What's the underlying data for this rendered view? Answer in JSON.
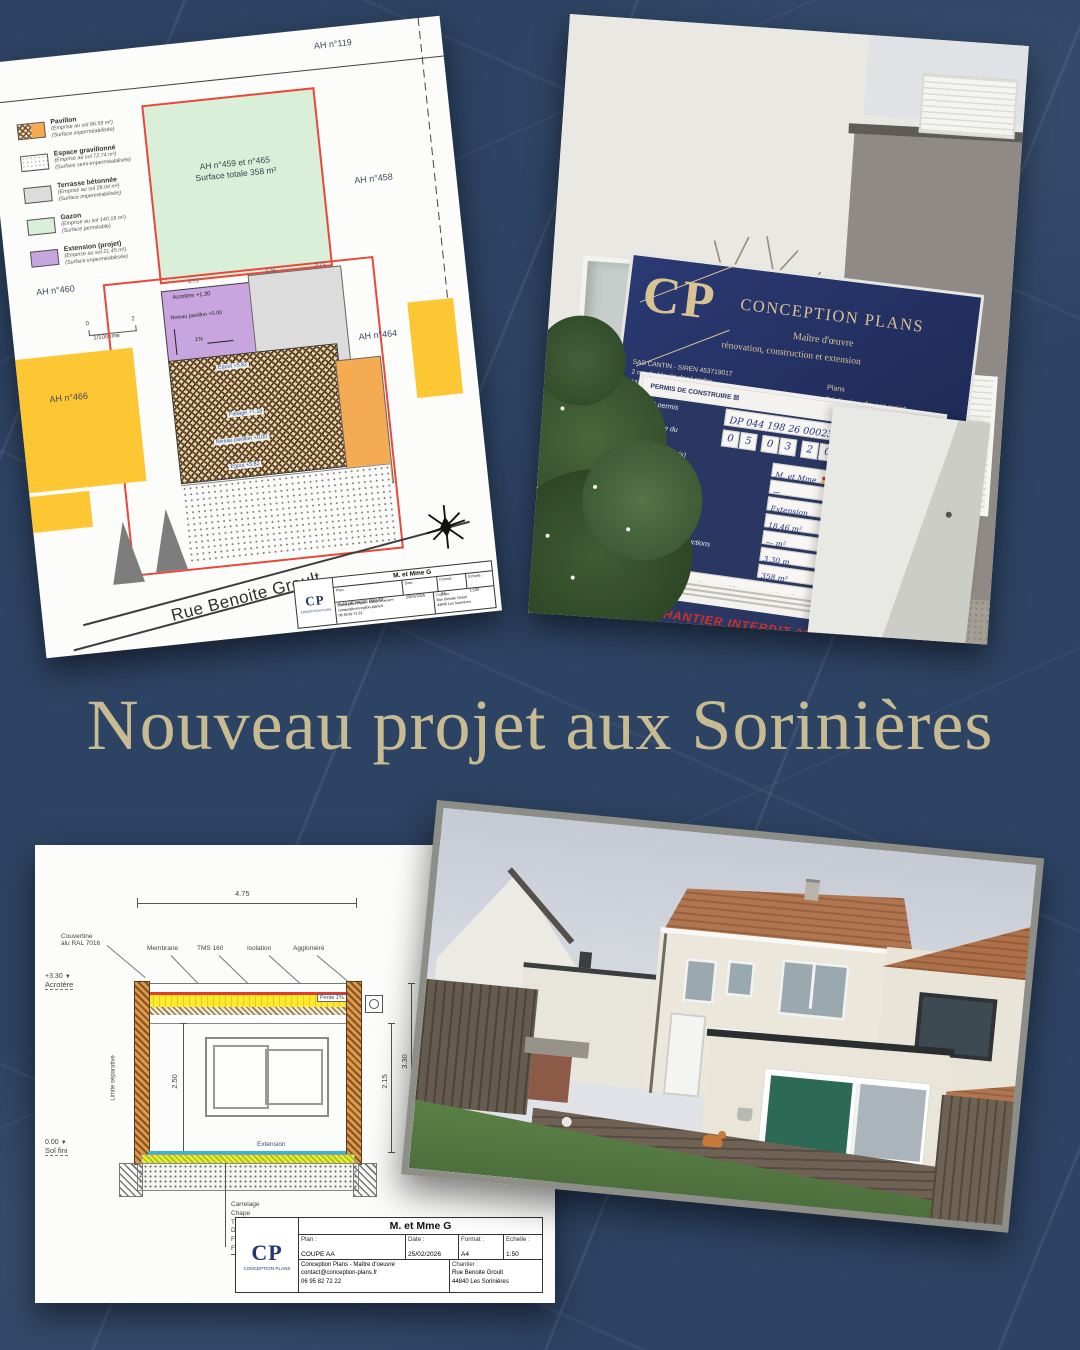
{
  "headline": "Nouveau projet aux Sorinières",
  "site_plan": {
    "parcel_ah119": "AH n°119",
    "parcel_ah458": "AH n°458",
    "parcel_ah460": "AH n°460",
    "parcel_ah464": "AH n°464",
    "parcel_ah466": "AH n°466",
    "green_line1": "AH n°459 et n°465",
    "green_line2": "Surface totale 358 m²",
    "legend": [
      {
        "name": "Pavillon",
        "emprise": "(Emprise au sol 86.59 m²)",
        "surface": "(Surface imperméabilisée)"
      },
      {
        "name": "Espace gravillonné",
        "emprise": "(Emprise au sol 72.74 m²)",
        "surface": "(Surface semi-imperméabilisée)"
      },
      {
        "name": "Terrasse bétonnée",
        "emprise": "(Emprise au sol 28.04 m²)",
        "surface": "(Surface imperméabilisée)"
      },
      {
        "name": "Gazon",
        "emprise": "(Emprise au sol 140.18 m²)",
        "surface": "(Surface perméable)"
      },
      {
        "name": "Extension (projet)",
        "emprise": "(Emprise au sol 21.45 m²)",
        "surface": "(Surface imperméabilisée)"
      }
    ],
    "scale": {
      "left": "0",
      "right": "2",
      "label": "1/100ème"
    },
    "dims": {
      "d1": "4.75",
      "d2": "3.26",
      "d3": "3.71"
    },
    "ann_acrotere130": "Acrotère +1.30",
    "ann_niveau": "Niveau pavillon +0.00",
    "ann_pente1": "1%",
    "ann_egout_top": "Egout +5.82",
    "ann_faitage": "Faîtage +7.18",
    "ann_niveau2": "Niveau pavillon +0.00",
    "ann_egout_bottom": "Egout +5.82",
    "ann_acrotere330": "Acrotère +3.30",
    "street": "Rue Benoite Groult",
    "titleblock": {
      "logo_text": "CP",
      "logo_caption": "CONCEPTION PLANS",
      "client": "M. et Mme G",
      "plan_label": "Plan :",
      "plan_value": "PLAN DE MASSE PROJET",
      "date_label": "Date :",
      "date_value": "25/02/2026",
      "format_label": "Format :",
      "format_value": "A3",
      "echelle_label": "Echelle :",
      "echelle_value": "1:100",
      "company": "Conception Plans - Maître d'oeuvre",
      "email": "contact@conception-plans.fr",
      "phone": "06 95 82 72 22",
      "chantier_label": "Chantier :",
      "chantier1": "Rue Benoite Groult",
      "chantier2": "44840 Les Sorinières"
    }
  },
  "photo_top": {
    "sign": {
      "logo_text": "CP",
      "brand": "CONCEPTION PLANS",
      "tagline1": "Maître d'œuvre",
      "tagline2": "rénovation, construction et extension",
      "info": [
        "SAS CANTIN - SIREN 453719017",
        "2 rue du Moulin des Landes",
        "44840 LES SORINIÈRES",
        "06 95 82 72 22",
        "contact@conception-plans.fr",
        "www.conception-plans.fr"
      ],
      "services": [
        "Plans",
        "Réalisation d'avant-projet",
        "Permis de construire",
        "Suivi de chantier",
        "Accompagnement personnalisé"
      ]
    },
    "permit": {
      "title_left": "PERMIS DE CONSTRUIRE",
      "check_left": "☒",
      "title_right": "PERMIS DE DÉMOLIR",
      "check_right": "☐",
      "num_label": "N° permis",
      "num_value": "DP 044 198 26 00023",
      "date_label": "en date du",
      "date_digits": [
        "0",
        "5",
        "0",
        "3",
        "2",
        "0",
        "2",
        "6"
      ],
      "rows": [
        {
          "label": "Bénéficiaire(s)",
          "value": "M. et Mme"
        },
        {
          "label": "Architecte",
          "value": "—"
        },
        {
          "label": "Nature des travaux",
          "value": "Extension"
        },
        {
          "label": "Surface plancher",
          "value": "18,46 m²"
        },
        {
          "label": "Surface existante",
          "value": "—  m²"
        },
        {
          "label": "Hauteur des constructions",
          "value": "3,30 m"
        },
        {
          "label": "Superficie du terrain",
          "value": "358 m²"
        },
        {
          "label": "Mairie",
          "value": "Rue Georges Clemenceau, Les Sorinières (44840)"
        }
      ],
      "warning": "CHANTIER INTERDIT AU PUBLIC"
    }
  },
  "coupe": {
    "dim_top": "4.75",
    "lbl_couvertine": "Couvertine",
    "lbl_couvertine2": "alu RAL 7016",
    "lbl_membrane": "Membrane",
    "lbl_tms": "TMS 160",
    "lbl_isolation": "Isolation",
    "lbl_agglomere": "Aggloméré",
    "lbl_panne": "Panne",
    "lbl_acrotere": "Acrotère",
    "acrotere_val": "+3.30",
    "lbl_pente": "Pente 1%",
    "lbl_limite": "Limite séparative",
    "dim_250": "2.50",
    "lbl_solfini": "Sol fini",
    "solfini_val": "0.00",
    "lbl_extension": "Extension",
    "dim_330": "3.30",
    "dim_215": "2.15",
    "layers": [
      "Carrelage",
      "Chape",
      "TMS 100",
      "Dalle béton",
      "Film anti termite",
      "Forme de pierre compactée"
    ],
    "titleblock": {
      "logo_text": "CP",
      "logo_caption": "CONCEPTION PLANS",
      "client": "M. et Mme G",
      "plan_label": "Plan :",
      "plan_value": "COUPE AA",
      "date_label": "Date :",
      "date_value": "25/02/2026",
      "format_label": "Format :",
      "format_value": "A4",
      "echelle_label": "Echelle :",
      "echelle_value": "1:50",
      "company": "Conception Plans - Maître d'oeuvre",
      "email": "contact@conception-plans.fr",
      "phone": "06 95 82 72 22",
      "chantier_label": "Chantier :",
      "chantier1": "Rue Benoite Groult",
      "chantier2": "44840 Les Sorinières"
    }
  }
}
